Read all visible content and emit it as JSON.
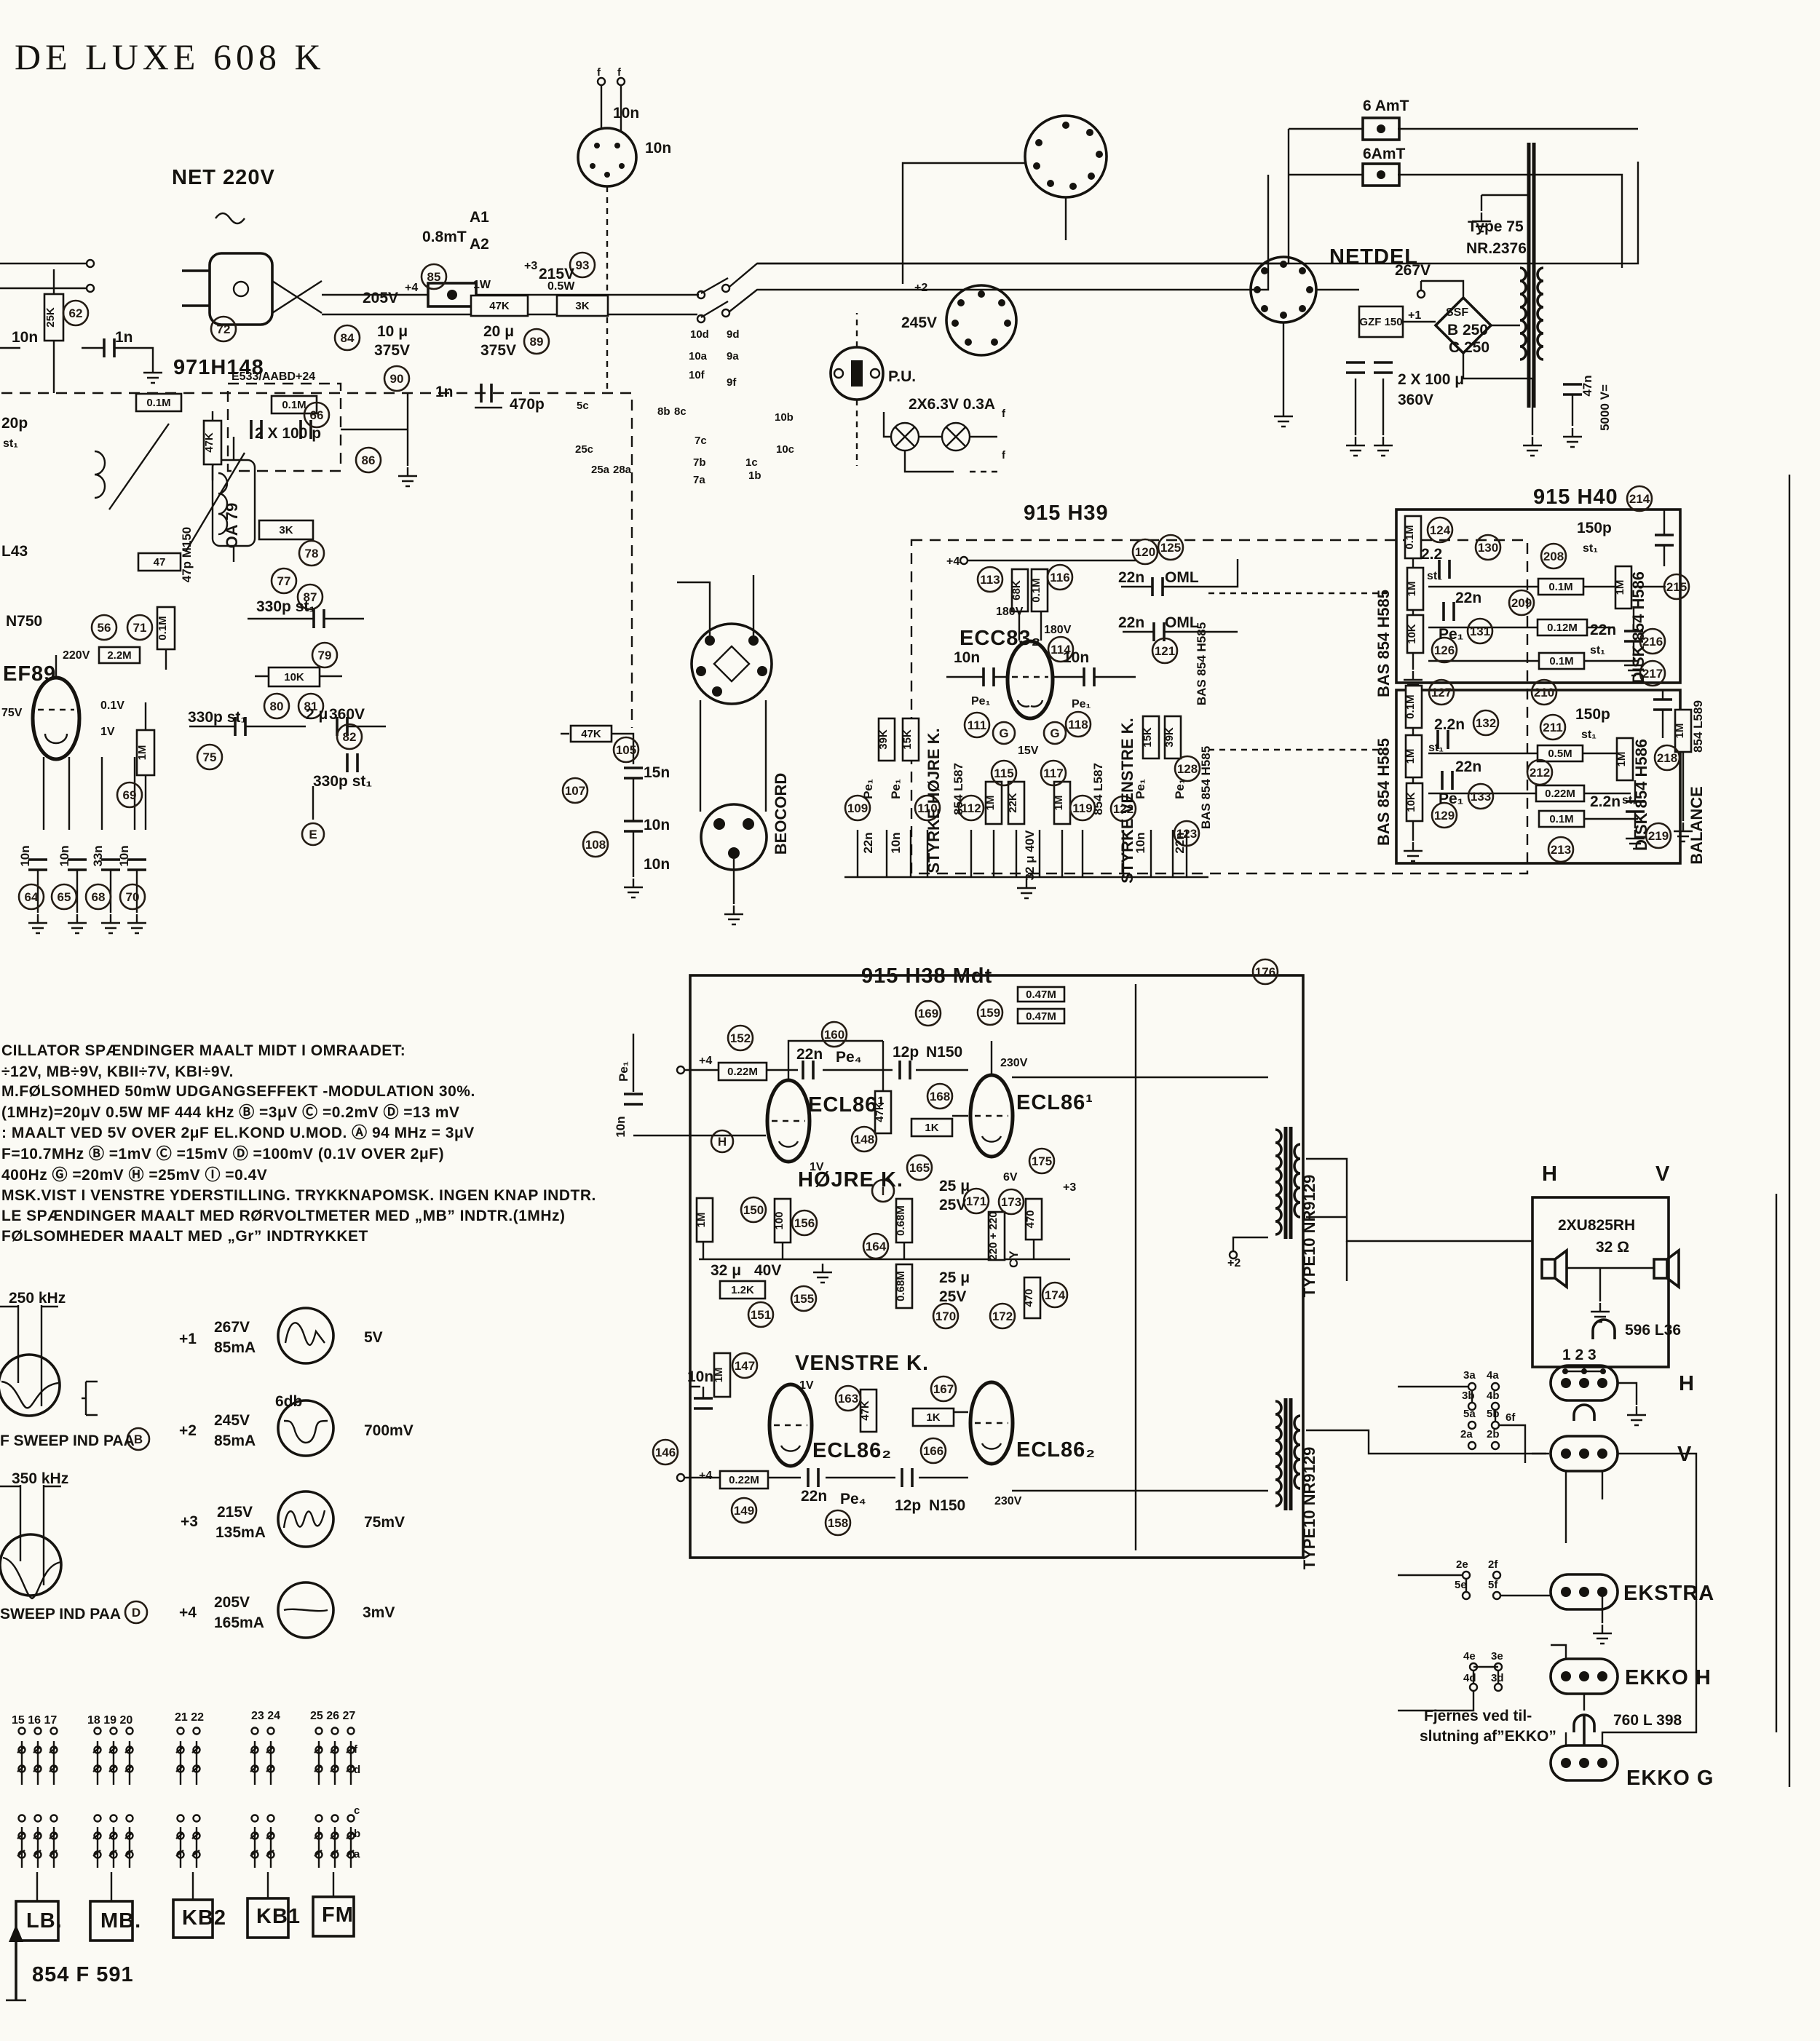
{
  "title": "DE LUXE 608 K",
  "footer": {
    "chassis": "854 F 591"
  },
  "power": {
    "net": "NET 220V",
    "fuse": "0.8mT",
    "a1": "A1",
    "a2": "A2",
    "v205": "205V",
    "p4": "+4",
    "w1": "1W",
    "r47k": "47K",
    "p3": "+3",
    "v215": "215V",
    "w05": "0.5W",
    "r3k": "3K",
    "c10u": "10 μ",
    "v375": "375V",
    "c20u": "20 μ",
    "v375b": "375V",
    "lamps": "2X6.3V 0.3A",
    "p2": "+2",
    "v245": "245V"
  },
  "netdel": {
    "name": "NETDEL",
    "fuse1": "6 AmT",
    "fuse2": "6AmT",
    "type": "Type 75",
    "nr": "NR.2376",
    "v267": "267V",
    "p1": "+1",
    "gz": "GZF 150",
    "ssf": "SSF",
    "b250": "B 250",
    "c250": "C 250",
    "cap": "2 X 100 μ",
    "v360": "360V",
    "c47n": "47n",
    "v5000": "5000 V="
  },
  "tuner": {
    "module": "971H148",
    "e533": "E533/AABD+24",
    "r01mA": "0.1M",
    "r01mB": "0.1M",
    "r01mC": "0.1M",
    "c2x100": "2 X 100 p",
    "c470p": "470p",
    "c1n": "1n",
    "c1nb": "1n",
    "c10n": "10n",
    "r25k": "25K",
    "c20p": "20p",
    "st1": "st₁",
    "l43": "L43",
    "n750": "N750",
    "ef89": "EF89",
    "v220": "220V",
    "v75": "75V",
    "v01": "0.1V",
    "v1": "1V",
    "r2m2": "2.2M",
    "c47p": "47p M150",
    "oa79": "OA 79",
    "r47": "47",
    "r47kv": "47K",
    "r3k": "3K",
    "r10k": "10K",
    "c330": "330p st₁",
    "c330b": "330p st₁",
    "c330c": "330p st₁",
    "c2u": "2 μ",
    "v360": "360V",
    "r1m": "1M",
    "c10na": "10n",
    "c10nb": "10n",
    "c33n": "33n",
    "c10nc": "10n",
    "c15n": "15n",
    "r47kB": "47K",
    "c10nd": "10n"
  },
  "mid": {
    "beocord": "BEOCORD",
    "pu": "P.U.",
    "c10n": "10n",
    "c10nb": "10n",
    "c10nc": "10n"
  },
  "preamp": {
    "module": "915 H39",
    "tube": "ECC83₂",
    "p4": "+4",
    "r68k": "68K",
    "r01m": "0.1M",
    "v180": "180V",
    "v180b": "180V",
    "v15": "15V",
    "c10n": "10n",
    "c10nb": "10n",
    "pe1": "Pe₁",
    "pe1b": "Pe₁",
    "c22n": "22n",
    "oml": "OML",
    "c22nb": "22n",
    "omlb": "OML",
    "styrkeh": "STYRKE HØJRE K.",
    "styrkev": "STYRKE VENSTRE K.",
    "potl": "854 L587",
    "potr": "854 L587",
    "basr": "BAS 854 H585",
    "basrb": "BAS 854 H585",
    "r39k": "39K",
    "r15k": "15K",
    "r1m": "1M",
    "r22k": "22K",
    "r1mB": "1M",
    "r15kB": "15K",
    "r39kB": "39K",
    "pe1c": "Pe₁",
    "c22nc": "22n",
    "pe1d": "Pe₁",
    "c10nc": "10n",
    "c32u": "32 μ 40V",
    "pe1e": "Pe₁",
    "c10nd": "10n",
    "pe1f": "Pe₁",
    "c22nd": "22n"
  },
  "tone": {
    "module": "915 H40",
    "bas": "BAS 854 H585",
    "basb": "BAS 854 H585",
    "disk": "DISK 854 H586",
    "diskb": "DISK 854 H586",
    "pot": "854 L589",
    "balance": "BALANCE",
    "r01mA": "0.1M",
    "r1mA": "1M",
    "r10kA": "10K",
    "r01mB": "0.1M",
    "r1mB": "1M",
    "r10kB": "10K",
    "r01mC": "0.1M",
    "r012m": "0.12M",
    "r01mD": "0.1M",
    "r05m": "0.5M",
    "r022m": "0.22M",
    "r01mE": "0.1M",
    "r1mC": "1M",
    "r1mD": "1M",
    "r1mE": "1M",
    "c22": "2.2",
    "st1": "st₁",
    "c22n": "22n",
    "pe1": "Pe₁",
    "c2n2": "2.2n",
    "st1b": "st₁",
    "c22nc": "22n",
    "pe1b": "Pe₁",
    "c150p": "150p",
    "st1c": "st₁",
    "c22nd": "22n",
    "st1d": "st₁",
    "c150pb": "150p",
    "st1e": "st₁",
    "c2n2b": "2.2n",
    "st1f": "st₁"
  },
  "amp": {
    "module": "915 H38 Mdt",
    "tube1": "ECL86¹",
    "tube1b": "ECL86¹",
    "tube2": "ECL86₂",
    "tube2b": "ECL86₂",
    "hojre": "HØJRE K.",
    "venstre": "VENSTRE K.",
    "r022m": "0.22M",
    "r022mb": "0.22M",
    "c22n": "22n",
    "pe4": "Pe₄",
    "c12p": "12p",
    "n150": "N150",
    "c22nb": "22n",
    "pe4b": "Pe₄",
    "c12pb": "12p",
    "n150b": "N150",
    "v230": "230V",
    "v230b": "230V",
    "v6": "6V",
    "v1": "1V",
    "v1b": "1V",
    "p4": "+4",
    "p4b": "+4",
    "p3": "+3",
    "p2": "+2",
    "r1m": "1M",
    "r1mb": "1M",
    "r100": "100",
    "r12k": "1.2K",
    "c32u": "32 μ",
    "v40": "40V",
    "r47k": "47K",
    "r47kb": "47K",
    "r1k": "1K",
    "r1kb": "1K",
    "r068m": "0.68M",
    "r068mb": "0.68M",
    "c25u": "25 μ",
    "v25": "25V",
    "c25ub": "25 μ",
    "v25b": "25V",
    "cy": "CY",
    "r220": "220 + 220",
    "r470": "470",
    "r470b": "470",
    "r047m": "0.47M",
    "r047mb": "0.47M",
    "c10n": "10n",
    "pe1": "Pe₁",
    "c10nb": "10n",
    "tr": "TYPE10 NR9129",
    "trb": "TYPE10 NR9129"
  },
  "out": {
    "htop": "H",
    "vtop": "V",
    "spk": "2XU825RH",
    "ohm": "32 Ω",
    "coil": "596 L36",
    "jumper": "1 2 3",
    "h": "H",
    "v": "V",
    "ekstra": "EKSTRA",
    "ekkoh": "EKKO H",
    "ekkog": "EKKO G",
    "l398": "760 L 398",
    "note1": "Fjernes ved til-",
    "note2": "slutning af”EKKO”"
  },
  "notes": {
    "lines": [
      "CILLATOR SPÆNDINGER MAALT MIDT I OMRAADET:",
      "÷12V, MB÷9V, KBII÷7V, KBI÷9V.",
      "M.FØLSOMHED 50mW UDGANGSEFFEKT -MODULATION 30%.",
      "(1MHz)=20μV 0.5W MF 444 kHz Ⓑ =3μV Ⓒ =0.2mV Ⓓ =13 mV",
      ": MAALT VED 5V OVER 2μF EL.KOND U.MOD. Ⓐ 94 MHz = 3μV",
      "F=10.7MHz Ⓑ =1mV Ⓒ =15mV Ⓓ =100mV (0.1V OVER 2μF)",
      "400Hz Ⓖ =20mV Ⓗ =25mV Ⓘ =0.4V",
      "MSK.VIST I VENSTRE YDERSTILLING. TRYKKNAPOMSK. INGEN KNAP INDTR.",
      "LE SPÆNDINGER MAALT MED RØRVOLTMETER MED „MB” INDTR.(1MHz)",
      "FØLSOMHEDER MAALT MED „Gr” INDTRYKKET"
    ]
  },
  "legend": {
    "f250": "250 kHz",
    "db": "6db",
    "sweep1": "F SWEEP IND PAA",
    "f350": "350 kHz",
    "sweep2": "SWEEP IND PAA",
    "rows": [
      {
        "tap": "+1",
        "v": "267V",
        "i": "85mA",
        "sig": "5V"
      },
      {
        "tap": "+2",
        "v": "245V",
        "i": "85mA",
        "sig": "700mV"
      },
      {
        "tap": "+3",
        "v": "215V",
        "i": "135mA",
        "sig": "75mV"
      },
      {
        "tap": "+4",
        "v": "205V",
        "i": "165mA",
        "sig": "3mV"
      }
    ]
  },
  "bands": {
    "g1": "15 16 17",
    "g2": "18 19 20",
    "g3": "21 22",
    "g4": "23 24",
    "g5": "25 26 27",
    "lb": "LB.",
    "mb": "MB.",
    "kb2": "KB2",
    "kb1": "KB1",
    "fm": "FM"
  },
  "letters": {
    "e": "E",
    "h": "H",
    "i": "I",
    "g1": "G",
    "g2": "G",
    "b": "B",
    "d": "D"
  },
  "pins": {
    "f": "f",
    "p5c": "5c",
    "p8b": "8b",
    "p8c": "8c",
    "p10d": "10d",
    "p9d": "9d",
    "p10a": "10a",
    "p9a": "9a",
    "p10f": "10f",
    "p9f": "9f",
    "p10b": "10b",
    "p7c": "7c",
    "p10c": "10c",
    "p7b": "7b",
    "p1c": "1c",
    "p7a": "7a",
    "p1b": "1b",
    "p25c": "25c",
    "p25a": "25a",
    "p28a": "28a",
    "p3a": "3a",
    "p4a": "4a",
    "p3b": "3b",
    "p4b": "4b",
    "p5a": "5a",
    "p5b": "5b",
    "p6f": "6f",
    "p2a": "2a",
    "p2b": "2b",
    "p2e": "2e",
    "p2f": "2f",
    "p5e": "5e",
    "p5f": "5f",
    "p4e": "4e",
    "p3e": "3e",
    "p4d": "4d",
    "p3d": "3d",
    "la": "a",
    "lb2": "b",
    "lc": "c",
    "ld": "d"
  },
  "refs": {
    "c56": "56",
    "c62": "62",
    "c64": "64",
    "c65": "65",
    "c66": "66",
    "c68": "68",
    "c69": "69",
    "c70": "70",
    "c71": "71",
    "c72": "72",
    "c75": "75",
    "c77": "77",
    "c78": "78",
    "c79": "79",
    "c80": "80",
    "c81": "81",
    "c82": "82",
    "c84": "84",
    "c85": "85",
    "c86": "86",
    "c87": "87",
    "c89": "89",
    "c90": "90",
    "c93": "93",
    "c105": "105",
    "c107": "107",
    "c108": "108",
    "c109": "109",
    "c110": "110",
    "c111": "111",
    "c112": "112",
    "c113": "113",
    "c114": "114",
    "c115": "115",
    "c116": "116",
    "c117": "117",
    "c118": "118",
    "c119": "119",
    "c120": "120",
    "c121": "121",
    "c122": "122",
    "c123": "123",
    "c124": "124",
    "c125": "125",
    "c126": "126",
    "c127": "127",
    "c128": "128",
    "c129": "129",
    "c130": "130",
    "c131": "131",
    "c132": "132",
    "c133": "133",
    "c146": "146",
    "c147": "147",
    "c148": "148",
    "c149": "149",
    "c150": "150",
    "c151": "151",
    "c152": "152",
    "c155": "155",
    "c156": "156",
    "c158": "158",
    "c159": "159",
    "c160": "160",
    "c163": "163",
    "c164": "164",
    "c165": "165",
    "c166": "166",
    "c167": "167",
    "c168": "168",
    "c169": "169",
    "c170": "170",
    "c171": "171",
    "c172": "172",
    "c173": "173",
    "c174": "174",
    "c175": "175",
    "c176": "176",
    "c208": "208",
    "c209": "209",
    "c210": "210",
    "c211": "211",
    "c212": "212",
    "c213": "213",
    "c214": "214",
    "c215": "215",
    "c216": "216",
    "c217": "217",
    "c218": "218",
    "c219": "219"
  }
}
